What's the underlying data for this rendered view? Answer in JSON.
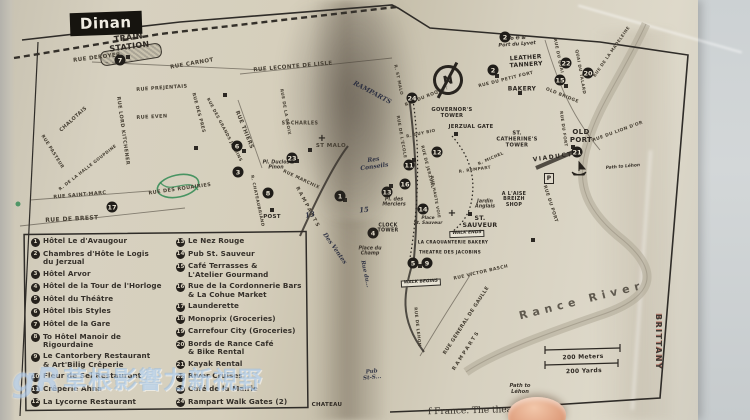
{
  "map": {
    "title": "Dinan",
    "compass_letter": "N",
    "edge_stamp": "BRITTANY",
    "parking_label": "P",
    "church_glyph": "+",
    "bottom_caption_fragment": "f France. The theater",
    "colors": {
      "paper": "#d6cfbc",
      "ink": "#2d2822",
      "pen_ink": "#212a3a",
      "green_ink": "#2f8a52",
      "table": "#ccd1d3",
      "watermark_blue": "#8cb9eb"
    },
    "labels": [
      {
        "t": "TRAIN\nSTATION",
        "x": 129,
        "y": 43,
        "r": -7,
        "s": 8,
        "c": "poi"
      },
      {
        "t": "RUE DEROYER",
        "x": 97,
        "y": 58,
        "r": -7,
        "s": 5.5,
        "c": "st"
      },
      {
        "t": "RUE CARNOT",
        "x": 192,
        "y": 64,
        "r": -10,
        "s": 5.5,
        "c": "st"
      },
      {
        "t": "RUE PREJENTAIS",
        "x": 162,
        "y": 89,
        "r": -4,
        "s": 5,
        "c": "st"
      },
      {
        "t": "RUE EVEN",
        "x": 152,
        "y": 118,
        "r": -3,
        "s": 5,
        "c": "st"
      },
      {
        "t": "RUE LORD KITCHENER",
        "x": 122,
        "y": 131,
        "r": 82,
        "s": 5,
        "c": "st"
      },
      {
        "t": "CHALOTAIS",
        "x": 74,
        "y": 120,
        "r": -42,
        "s": 5,
        "c": "st"
      },
      {
        "t": "RUE PASTEUR",
        "x": 52,
        "y": 152,
        "r": 58,
        "s": 4.5,
        "c": "st"
      },
      {
        "t": "R. DE LA HALLE GOUPDINE",
        "x": 88,
        "y": 168,
        "r": -38,
        "s": 4.2,
        "c": "st"
      },
      {
        "t": "RUE SAINT-MARC",
        "x": 80,
        "y": 196,
        "r": -5,
        "s": 5,
        "c": "st"
      },
      {
        "t": "RUE DE BREST",
        "x": 72,
        "y": 220,
        "r": -3,
        "s": 6,
        "c": "st"
      },
      {
        "t": "RUE DES ROUAIRIES",
        "x": 180,
        "y": 190,
        "r": -8,
        "s": 5,
        "c": "st"
      },
      {
        "t": "RUE DES PRES",
        "x": 198,
        "y": 113,
        "r": 75,
        "s": 4.5,
        "c": "st"
      },
      {
        "t": "RUE DES GRANDS JARDINS",
        "x": 224,
        "y": 130,
        "r": 62,
        "s": 4.2,
        "c": "st"
      },
      {
        "t": "RUE THIERS",
        "x": 244,
        "y": 130,
        "r": 68,
        "s": 5.5,
        "c": "st"
      },
      {
        "t": "RUE DE LA CROIX",
        "x": 285,
        "y": 112,
        "r": 80,
        "s": 4.2,
        "c": "st"
      },
      {
        "t": "RUE LECONTE DE LISLE",
        "x": 293,
        "y": 67,
        "r": -5,
        "s": 5.5,
        "c": "st"
      },
      {
        "t": "ST-CHARLES",
        "x": 300,
        "y": 124,
        "r": 0,
        "s": 4.8,
        "c": "st"
      },
      {
        "t": "ST MALO",
        "x": 331,
        "y": 146,
        "r": 0,
        "s": 5.5,
        "c": "st"
      },
      {
        "t": "RUE MARCHIX",
        "x": 301,
        "y": 180,
        "r": 25,
        "s": 4.5,
        "c": "st"
      },
      {
        "t": "RAMPARTS",
        "x": 307,
        "y": 208,
        "r": 62,
        "s": 5,
        "c": "st",
        "ls": 2
      },
      {
        "t": "R. CHATEAUBRIAND",
        "x": 257,
        "y": 201,
        "r": 78,
        "s": 4.2,
        "c": "st"
      },
      {
        "t": "POST",
        "x": 272,
        "y": 217,
        "r": 0,
        "s": 5.5,
        "c": "poi"
      },
      {
        "t": "RUE DE L'ECOLE",
        "x": 401,
        "y": 137,
        "r": 80,
        "s": 4.2,
        "c": "st"
      },
      {
        "t": "R. GUY BIO",
        "x": 421,
        "y": 134,
        "r": -12,
        "s": 4.2,
        "c": "st"
      },
      {
        "t": "R. ST MALO",
        "x": 398,
        "y": 80,
        "r": 78,
        "s": 4.2,
        "c": "st"
      },
      {
        "t": "RUE DU ROQUET",
        "x": 427,
        "y": 97,
        "r": -22,
        "s": 4.5,
        "c": "st"
      },
      {
        "t": "RUE DU PETIT FORT",
        "x": 506,
        "y": 80,
        "r": -14,
        "s": 4.5,
        "c": "st"
      },
      {
        "t": "RUE DU QUAI",
        "x": 558,
        "y": 56,
        "r": 78,
        "s": 4.2,
        "c": "st"
      },
      {
        "t": "QUAI DU TALARD",
        "x": 580,
        "y": 72,
        "r": 80,
        "s": 4.2,
        "c": "st"
      },
      {
        "t": "RUE DE LA MADELEINE",
        "x": 612,
        "y": 52,
        "r": -55,
        "s": 4.2,
        "c": "st"
      },
      {
        "t": "OLD BRIDGE",
        "x": 562,
        "y": 96,
        "r": 22,
        "s": 4.5,
        "c": "st"
      },
      {
        "t": "RUE DU FORT",
        "x": 563,
        "y": 129,
        "r": 82,
        "s": 4.2,
        "c": "st"
      },
      {
        "t": "RUE DU LION D'OR",
        "x": 618,
        "y": 132,
        "r": -20,
        "s": 4.5,
        "c": "st"
      },
      {
        "t": "RUE DE JERZUAL",
        "x": 427,
        "y": 167,
        "r": 76,
        "s": 4.2,
        "c": "st"
      },
      {
        "t": "RUE HAUTE VOIE",
        "x": 435,
        "y": 197,
        "r": 80,
        "s": 4,
        "c": "st"
      },
      {
        "t": "R. REMPART",
        "x": 475,
        "y": 170,
        "r": -8,
        "s": 4.2,
        "c": "st"
      },
      {
        "t": "R. MICHEL",
        "x": 491,
        "y": 159,
        "r": -24,
        "s": 4.2,
        "c": "st"
      },
      {
        "t": "RUE DU PORT",
        "x": 550,
        "y": 204,
        "r": 72,
        "s": 4.5,
        "c": "st"
      },
      {
        "t": "RUE VICTOR BASCH",
        "x": 481,
        "y": 273,
        "r": -13,
        "s": 4.5,
        "c": "st"
      },
      {
        "t": "RUE GENERAL DE GAULLE",
        "x": 467,
        "y": 321,
        "r": -57,
        "s": 5,
        "c": "st"
      },
      {
        "t": "RAMPARTS",
        "x": 467,
        "y": 351,
        "r": -57,
        "s": 5,
        "c": "st",
        "ls": 2
      },
      {
        "t": "RUE DE LEHON",
        "x": 417,
        "y": 327,
        "r": 84,
        "s": 4.2,
        "c": "st"
      },
      {
        "t": "LEATHER\nTANNERY",
        "x": 526,
        "y": 62,
        "r": -4,
        "s": 6,
        "c": "poi"
      },
      {
        "t": "BAKERY",
        "x": 522,
        "y": 90,
        "r": 0,
        "s": 6,
        "c": "poi"
      },
      {
        "t": "GOVERNOR'S\nTOWER",
        "x": 452,
        "y": 114,
        "r": 0,
        "s": 5.2,
        "c": "poi"
      },
      {
        "t": "JERZUAL GATE",
        "x": 471,
        "y": 128,
        "r": 0,
        "s": 5.2,
        "c": "poi"
      },
      {
        "t": "ST.\nCATHERINE'S\nTOWER",
        "x": 517,
        "y": 140,
        "r": 0,
        "s": 5.2,
        "c": "poi"
      },
      {
        "t": "OLD\nPORT",
        "x": 581,
        "y": 137,
        "r": 0,
        "s": 7,
        "c": "poi"
      },
      {
        "t": "VIADUCT",
        "x": 553,
        "y": 158,
        "r": -8,
        "s": 6,
        "c": "poi",
        "ls": 1.5
      },
      {
        "t": "CLOCK\nTOWER",
        "x": 388,
        "y": 229,
        "r": 0,
        "s": 4.8,
        "c": "poi"
      },
      {
        "t": "A L'AISE\nBREIZH\nSHOP",
        "x": 514,
        "y": 200,
        "r": 0,
        "s": 4.8,
        "c": "poi"
      },
      {
        "t": "ST.\nSAUVEUR",
        "x": 480,
        "y": 223,
        "r": 0,
        "s": 6.2,
        "c": "poi"
      },
      {
        "t": "LA CRAQUANTERIE BAKERY",
        "x": 453,
        "y": 243,
        "r": 0,
        "s": 4.2,
        "c": "poi"
      },
      {
        "t": "THEATRE DES JACOBINS",
        "x": 450,
        "y": 253,
        "r": 0,
        "s": 4.2,
        "c": "poi"
      },
      {
        "t": "200 Meters",
        "x": 583,
        "y": 358,
        "r": -2,
        "s": 6,
        "c": "poi"
      },
      {
        "t": "200 Yards",
        "x": 584,
        "y": 372,
        "r": -2,
        "s": 6,
        "c": "poi"
      },
      {
        "t": "CHATEAU",
        "x": 327,
        "y": 405,
        "r": 0,
        "s": 5.5,
        "c": "poi"
      },
      {
        "t": "Pl. Duclos\nPinon",
        "x": 276,
        "y": 166,
        "r": 0,
        "s": 4.8,
        "c": "it"
      },
      {
        "t": "Pl. des\nMerciers",
        "x": 394,
        "y": 203,
        "r": 0,
        "s": 4.8,
        "c": "it"
      },
      {
        "t": "Place\nSt. Sauveur",
        "x": 428,
        "y": 222,
        "r": 0,
        "s": 4.4,
        "c": "it"
      },
      {
        "t": "Place du\nChamp",
        "x": 370,
        "y": 252,
        "r": 0,
        "s": 4.8,
        "c": "it"
      },
      {
        "t": "Jardin\nAnglais",
        "x": 485,
        "y": 205,
        "r": 0,
        "s": 4.8,
        "c": "it"
      },
      {
        "t": "Path to Léhon",
        "x": 623,
        "y": 168,
        "r": -5,
        "s": 4.4,
        "c": "it"
      },
      {
        "t": "Path to\nLéhon",
        "x": 520,
        "y": 390,
        "r": 0,
        "s": 5.2,
        "c": "it"
      },
      {
        "t": "To ❷ &\nPort du Lyvet",
        "x": 517,
        "y": 42,
        "r": -4,
        "s": 5,
        "c": "it"
      },
      {
        "t": "WALK BEGINS",
        "x": 421,
        "y": 283,
        "r": -3,
        "s": 4.4,
        "c": "bx"
      },
      {
        "t": "WALK ENDS",
        "x": 467,
        "y": 234,
        "r": -2,
        "s": 4.4,
        "c": "bx"
      },
      {
        "t": "RAMPARTS",
        "x": 372,
        "y": 93,
        "r": 28,
        "s": 6.5,
        "c": "hand"
      },
      {
        "t": "Res\nConseils",
        "x": 374,
        "y": 164,
        "r": -8,
        "s": 6,
        "c": "hand"
      },
      {
        "t": "Des Ventes",
        "x": 334,
        "y": 249,
        "r": 55,
        "s": 6,
        "c": "hand"
      },
      {
        "t": "13",
        "x": 310,
        "y": 215,
        "r": -10,
        "s": 7,
        "c": "hand"
      },
      {
        "t": "15",
        "x": 364,
        "y": 210,
        "r": -5,
        "s": 7,
        "c": "hand"
      },
      {
        "t": "Rue du...",
        "x": 365,
        "y": 274,
        "r": 78,
        "s": 5.5,
        "c": "hand"
      },
      {
        "t": "Pub\nSt-S...",
        "x": 372,
        "y": 375,
        "r": -6,
        "s": 5.5,
        "c": "hand"
      },
      {
        "t": "Rance River",
        "x": 582,
        "y": 301,
        "r": -14,
        "s": 11,
        "c": "riv"
      }
    ],
    "markers": [
      {
        "n": "7",
        "x": 120,
        "y": 60
      },
      {
        "n": "17",
        "x": 112,
        "y": 207
      },
      {
        "n": "6",
        "x": 237,
        "y": 146
      },
      {
        "n": "3",
        "x": 238,
        "y": 172
      },
      {
        "n": "23",
        "x": 292,
        "y": 158
      },
      {
        "n": "8",
        "x": 268,
        "y": 193
      },
      {
        "n": "1",
        "x": 340,
        "y": 196
      },
      {
        "n": "13",
        "x": 387,
        "y": 192
      },
      {
        "n": "16",
        "x": 405,
        "y": 184
      },
      {
        "n": "11",
        "x": 409,
        "y": 165
      },
      {
        "n": "4",
        "x": 373,
        "y": 233
      },
      {
        "n": "14",
        "x": 423,
        "y": 209
      },
      {
        "n": "5",
        "x": 413,
        "y": 263
      },
      {
        "n": "9",
        "x": 427,
        "y": 263
      },
      {
        "n": "2",
        "x": 493,
        "y": 70
      },
      {
        "n": "24",
        "x": 412,
        "y": 98
      },
      {
        "n": "12",
        "x": 437,
        "y": 152
      },
      {
        "n": "15",
        "x": 560,
        "y": 80
      },
      {
        "n": "22",
        "x": 566,
        "y": 63
      },
      {
        "n": "20",
        "x": 588,
        "y": 73
      },
      {
        "n": "21",
        "x": 577,
        "y": 152
      },
      {
        "n": "2",
        "x": 505,
        "y": 37
      }
    ],
    "buildings": [
      [
        128,
        57
      ],
      [
        244,
        151
      ],
      [
        297,
        161
      ],
      [
        272,
        210
      ],
      [
        345,
        200
      ],
      [
        391,
        186
      ],
      [
        414,
        160
      ],
      [
        470,
        214
      ],
      [
        497,
        76
      ],
      [
        520,
        93
      ],
      [
        566,
        86
      ],
      [
        573,
        147
      ],
      [
        420,
        266
      ],
      [
        456,
        134
      ],
      [
        533,
        240
      ],
      [
        310,
        150
      ],
      [
        196,
        148
      ],
      [
        225,
        95
      ]
    ],
    "churches": [
      [
        322,
        139
      ],
      [
        452,
        214
      ]
    ],
    "legend": {
      "left": [
        {
          "n": "1",
          "t": "Hôtel Le d'Avaugour"
        },
        {
          "n": "2",
          "t": "Chambres d'Hôte le Logis\ndu Jerzual"
        },
        {
          "n": "3",
          "t": "Hôtel Arvor"
        },
        {
          "n": "4",
          "t": "Hôtel de la Tour de l'Horloge"
        },
        {
          "n": "5",
          "t": "Hôtel du Théâtre"
        },
        {
          "n": "6",
          "t": "Hôtel Ibis Styles"
        },
        {
          "n": "7",
          "t": "Hôtel de la Gare"
        },
        {
          "n": "8",
          "t": "To Hôtel Manoir de\nRigourdaine"
        },
        {
          "n": "9",
          "t": "Le Cantorbery Restaurant\n& Art'Bilig Crêperie"
        },
        {
          "n": "10",
          "t": "Fleur de Sel Restaurant"
        },
        {
          "n": "11",
          "t": "Crêperie Ahna"
        },
        {
          "n": "12",
          "t": "La Lycorne Restaurant"
        }
      ],
      "right": [
        {
          "n": "13",
          "t": "Le Nez Rouge"
        },
        {
          "n": "14",
          "t": "Pub St. Sauveur"
        },
        {
          "n": "15",
          "t": "Café Terrasses &\nL'Atelier Gourmand"
        },
        {
          "n": "16",
          "t": "Rue de la Cordonnerie Bars\n& La Cohue Market"
        },
        {
          "n": "17",
          "t": "Launderette"
        },
        {
          "n": "18",
          "t": "Monoprix (Groceries)"
        },
        {
          "n": "19",
          "t": "Carrefour City (Groceries)"
        },
        {
          "n": "20",
          "t": "Bords de Rance Café\n& Bike Rental"
        },
        {
          "n": "21",
          "t": "Kayak Rental"
        },
        {
          "n": "22",
          "t": "River Cruises"
        },
        {
          "n": "23",
          "t": "Café de la Mairie"
        },
        {
          "n": "24",
          "t": "Rampart Walk Gates (2)"
        }
      ]
    }
  },
  "watermark": {
    "logo": "gR",
    "text": "草根影響力新視野"
  }
}
